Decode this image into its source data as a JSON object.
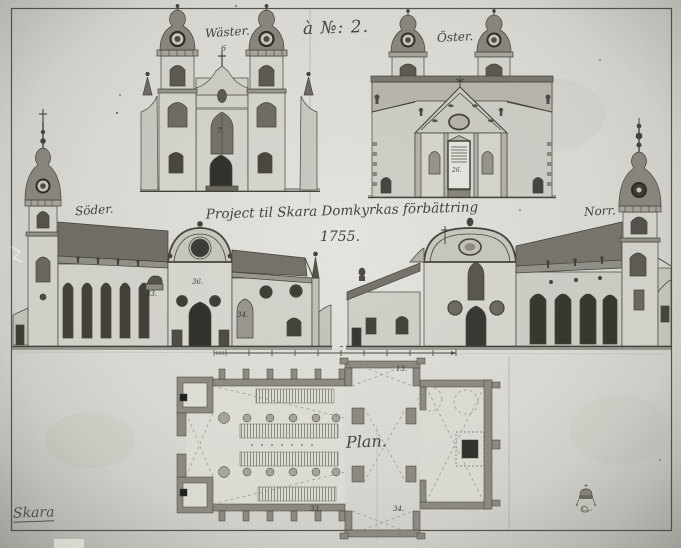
{
  "sheet": {
    "number": "à №: 2.",
    "title": "Project til Skara Domkyrkas förbättring",
    "year": "1755.",
    "archive_mark": "Skara"
  },
  "labels": {
    "west": "Wäster.",
    "east": "Öster.",
    "south": "Söder.",
    "north": "Norr.",
    "plan": "Plan."
  },
  "annotations": {
    "west_gable": "6",
    "west_window": "7.",
    "east_tablet": "26.",
    "south_nave": "33.",
    "south_transept": "36.",
    "south_choir_window": "34.",
    "plan_sacristy": "13.",
    "plan_south_transept": "33.",
    "plan_south_chapel": "34."
  },
  "colors": {
    "paper": "#dcdbd5",
    "ink": "#3a3933",
    "wall_wash": "#d6d5ce",
    "roof_wash": "#716f67",
    "opening_dark": "#3c3b34"
  }
}
